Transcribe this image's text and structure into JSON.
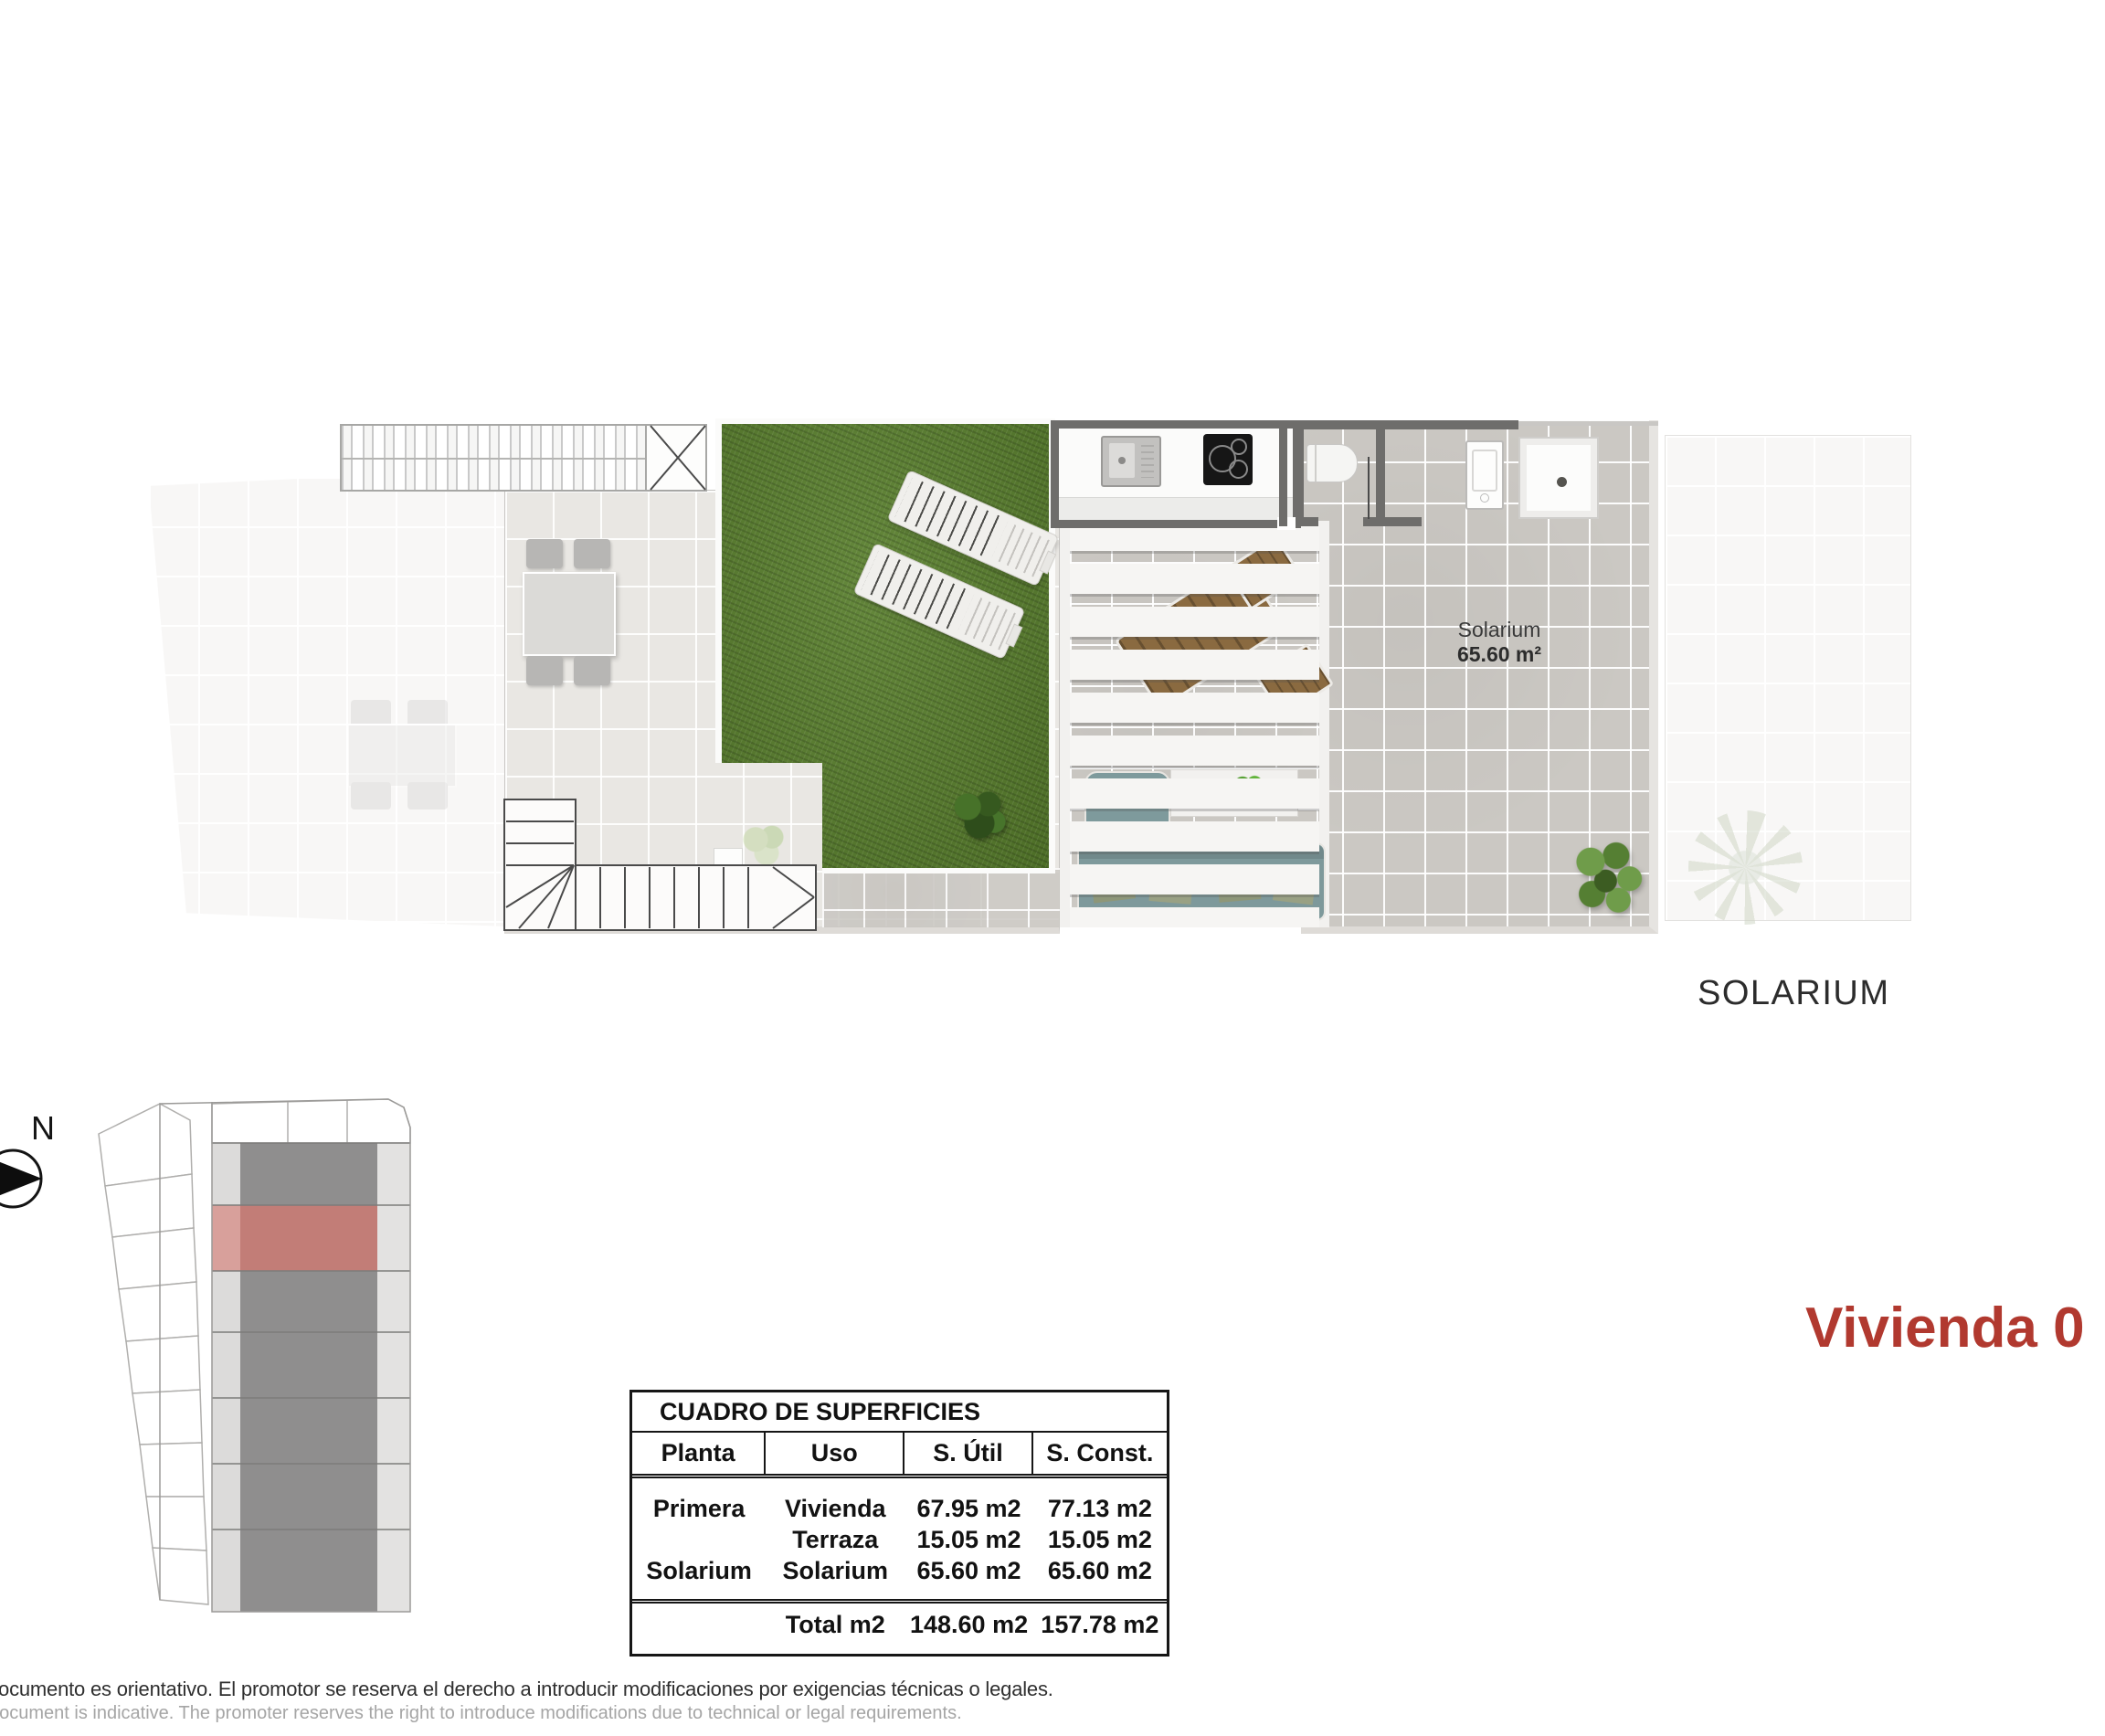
{
  "page": {
    "type": "floor-plan-sheet"
  },
  "compass": {
    "label": "N"
  },
  "plan": {
    "room_label": "Solarium",
    "room_area": "65.60 m²",
    "level_label": "SOLARIUM"
  },
  "unit_title": "Vivienda 0",
  "areas_table": {
    "title": "CUADRO DE SUPERFICIES",
    "columns": [
      "Planta",
      "Uso",
      "S. Útil",
      "S. Const."
    ],
    "rows": [
      {
        "planta": "Primera",
        "uso": "Vivienda",
        "util": "67.95 m2",
        "const": "77.13 m2"
      },
      {
        "planta": "",
        "uso": "Terraza",
        "util": "15.05 m2",
        "const": "15.05 m2"
      },
      {
        "planta": "Solarium",
        "uso": "Solarium",
        "util": "65.60 m2",
        "const": "65.60 m2"
      }
    ],
    "total": {
      "planta": "",
      "label": "Total m2",
      "util": "148.60 m2",
      "const": "157.78 m2"
    }
  },
  "disclaimer": {
    "es": "documento es orientativo. El promotor se reserva el derecho a introducir modificaciones por exigencias técnicas o legales.",
    "en": "document is indicative. The promoter reserves the right to introduce modifications due to technical or legal requirements."
  },
  "colors": {
    "accent_red": "#b1392f",
    "site_highlight": "#c27d77",
    "grass_green": "#597f2d"
  }
}
